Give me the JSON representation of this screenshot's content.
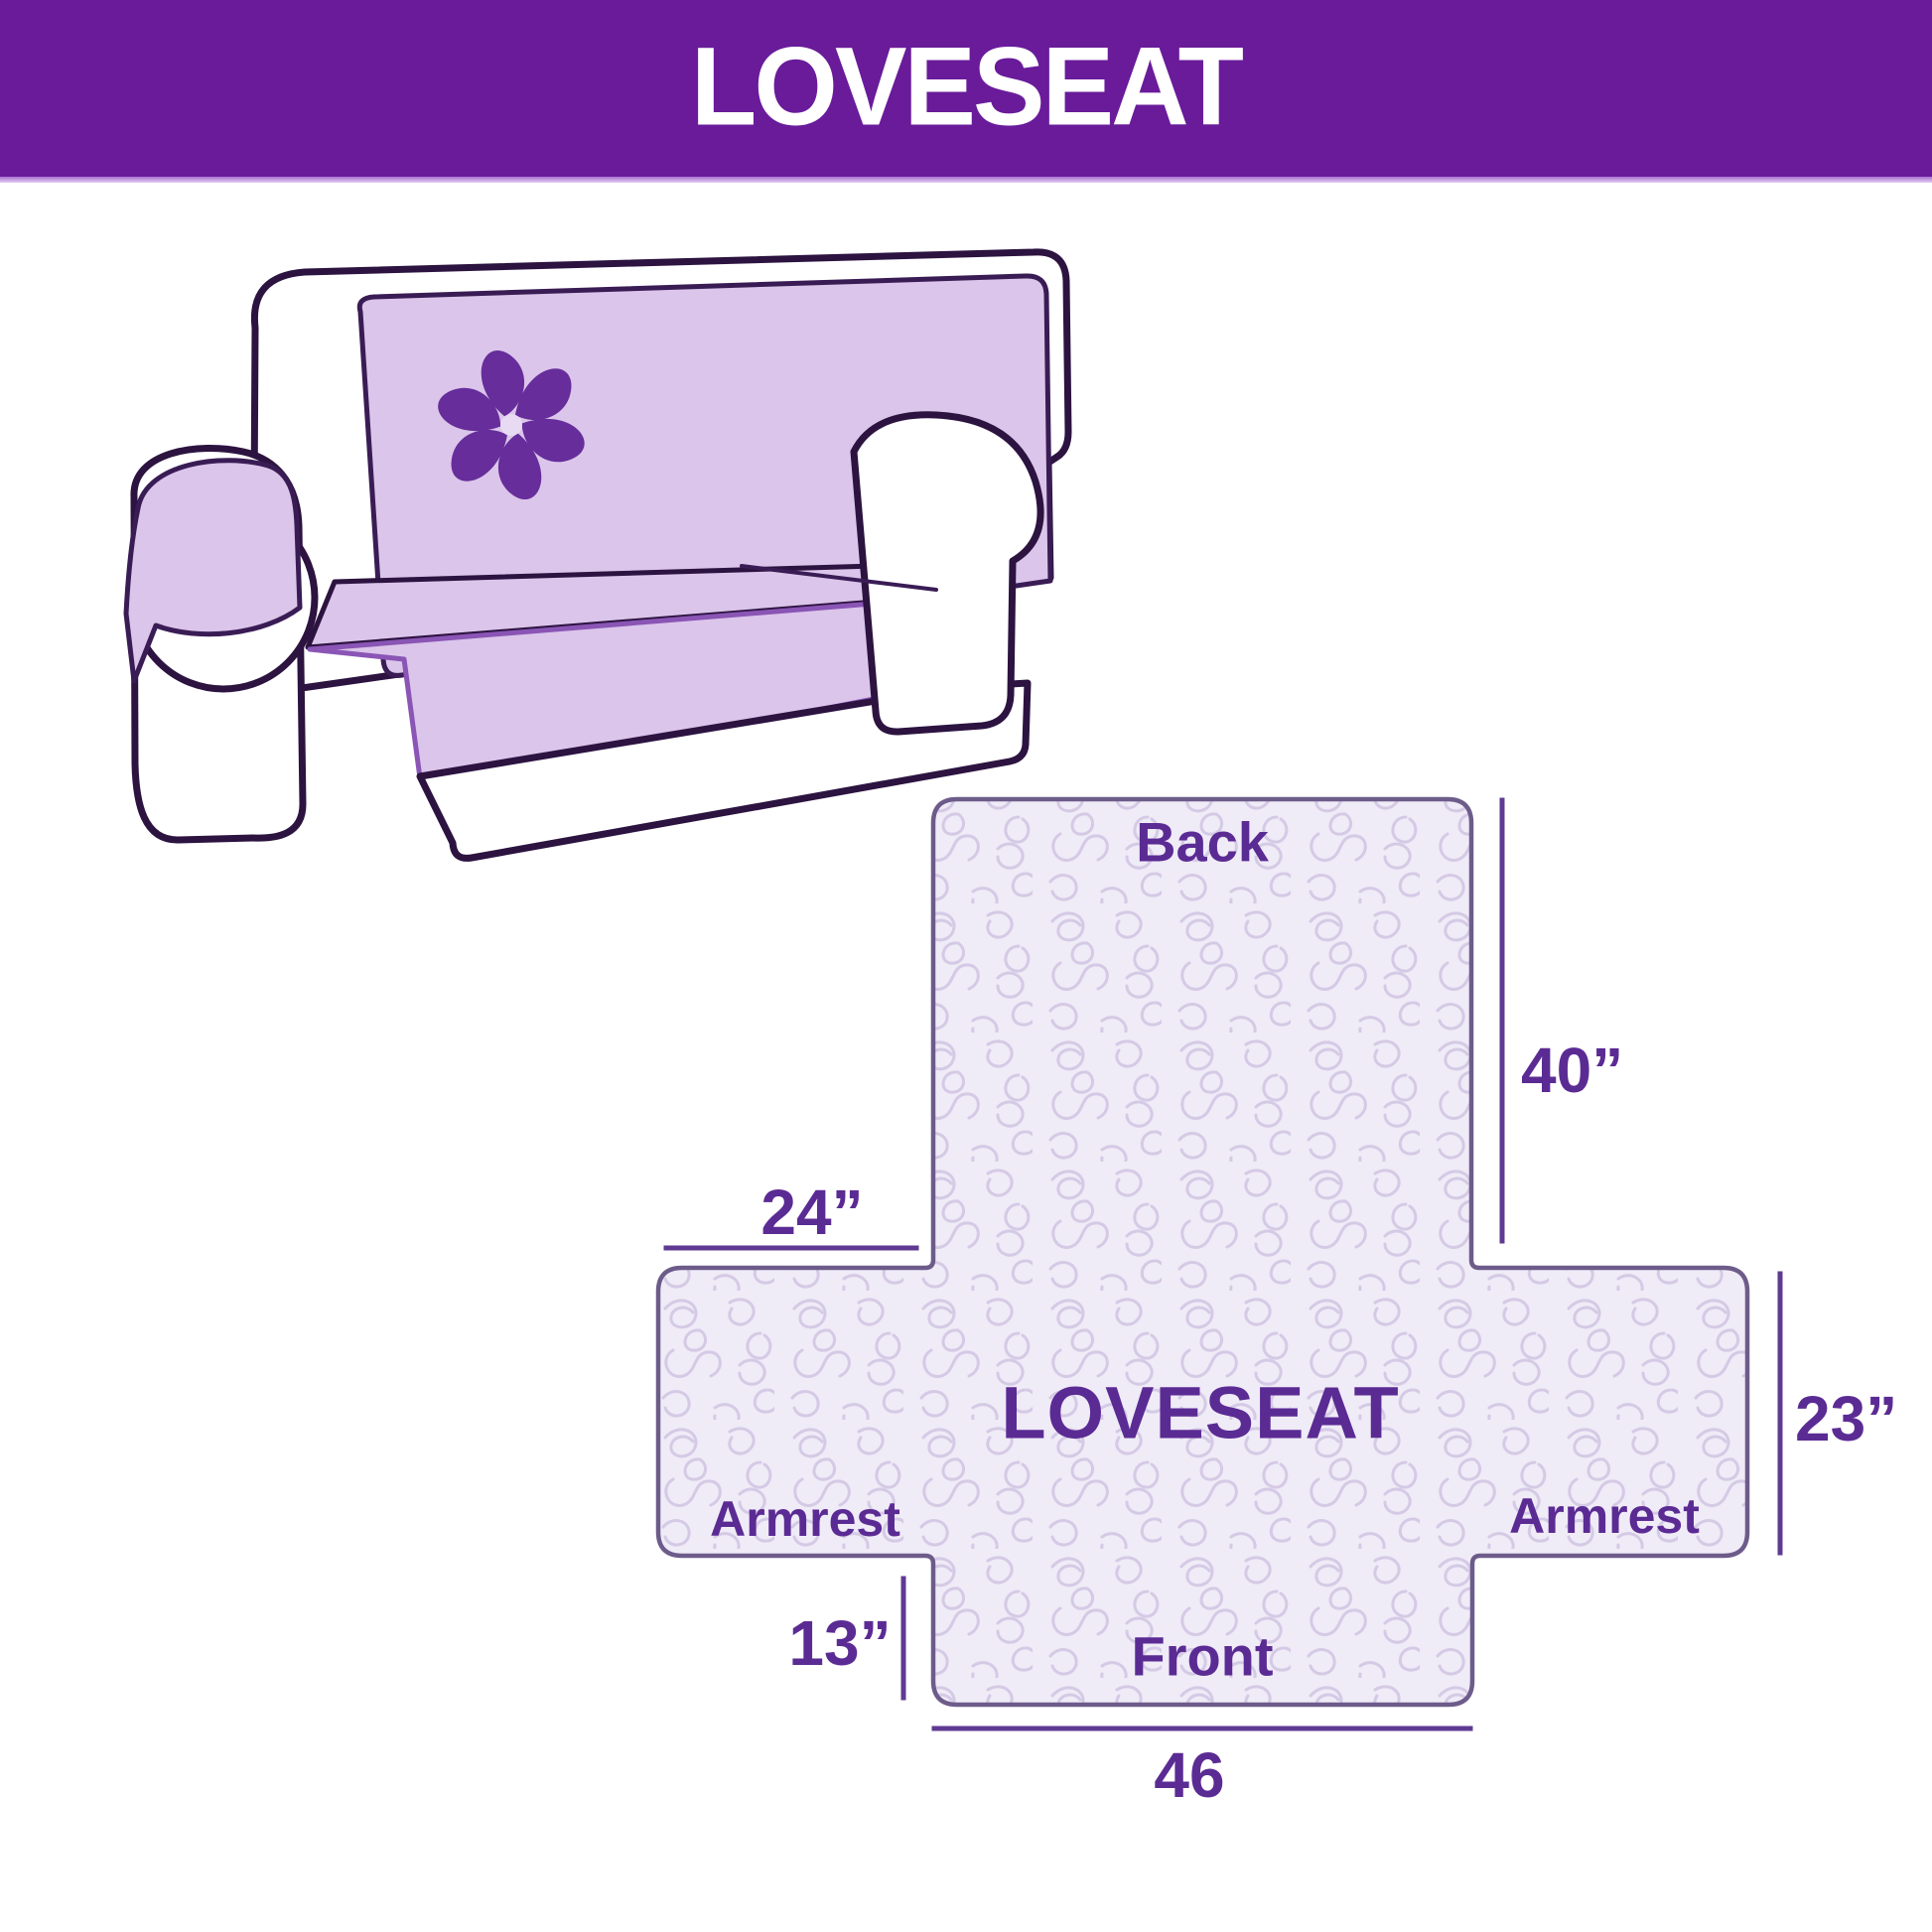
{
  "header": {
    "title": "LOVESEAT",
    "bg_color": "#691b9a",
    "text_color": "#ffffff",
    "divider_color": "#cfb3e4"
  },
  "illustration": {
    "name": "loveseat-sofa-with-cover",
    "cover_color": "#dbc5ea",
    "body_color": "#ffffff",
    "outline_color": "#2c1340",
    "logo_icon": "pinwheel-flower-icon",
    "logo_color": "#662d9b"
  },
  "diagram": {
    "shape_fill": "#efebf7",
    "shape_pattern_color": "#d5cae5",
    "shape_outline_color": "#6d5c8a",
    "line_color": "#5f3a92",
    "label_color": "#5b2b94",
    "labels": {
      "back": "Back",
      "center": "LOVESEAT",
      "armrest_left": "Armrest",
      "armrest_right": "Armrest",
      "front": "Front"
    },
    "dimensions": {
      "back_height": "40”",
      "armrest_top_width": "24”",
      "armrest_side_height": "23”",
      "front_flap_height": "13”",
      "front_width": "46"
    }
  }
}
